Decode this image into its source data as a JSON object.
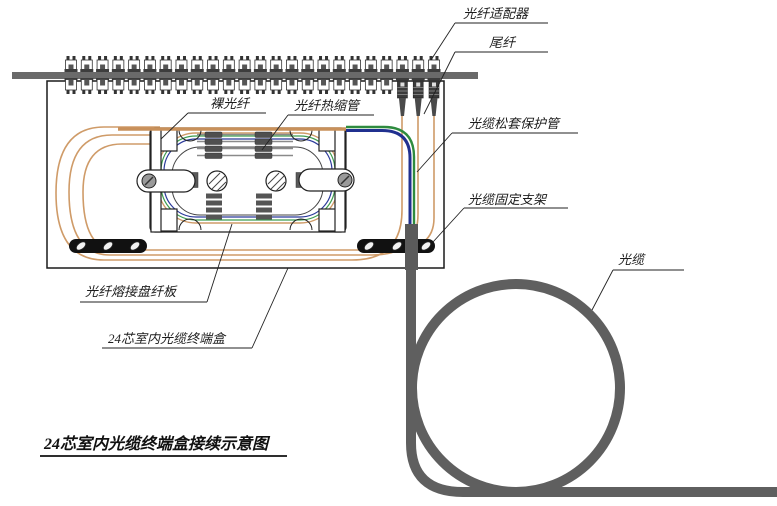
{
  "title": {
    "text": "24芯室内光缆终端盒接续示意图"
  },
  "labels": {
    "fiber_adapter": "光纤适配器",
    "pigtail": "尾纤",
    "bare_fiber": "裸光纤",
    "heat_shrink_tube": "光纤热缩管",
    "loose_tube_protector": "光缆松套保护管",
    "cable_fixing_bracket": "光缆固定支架",
    "optical_cable": "光缆",
    "splice_tray_panel": "光纤熔接盘纤板",
    "termination_box": "24芯室内光缆终端盒"
  },
  "counts": {
    "adapters": 24,
    "pigtails": 3,
    "slack_loops": 3,
    "splice_sleeve_rows": 4
  },
  "colors": {
    "fiber_orange": "#cf9b68",
    "tube_green": "#2e8b3e",
    "tube_blue": "#20308f",
    "cable_gray": "#5f5f5f",
    "panel_bar_gray": "#6a6a6a",
    "line_black": "#1a1a1a"
  }
}
